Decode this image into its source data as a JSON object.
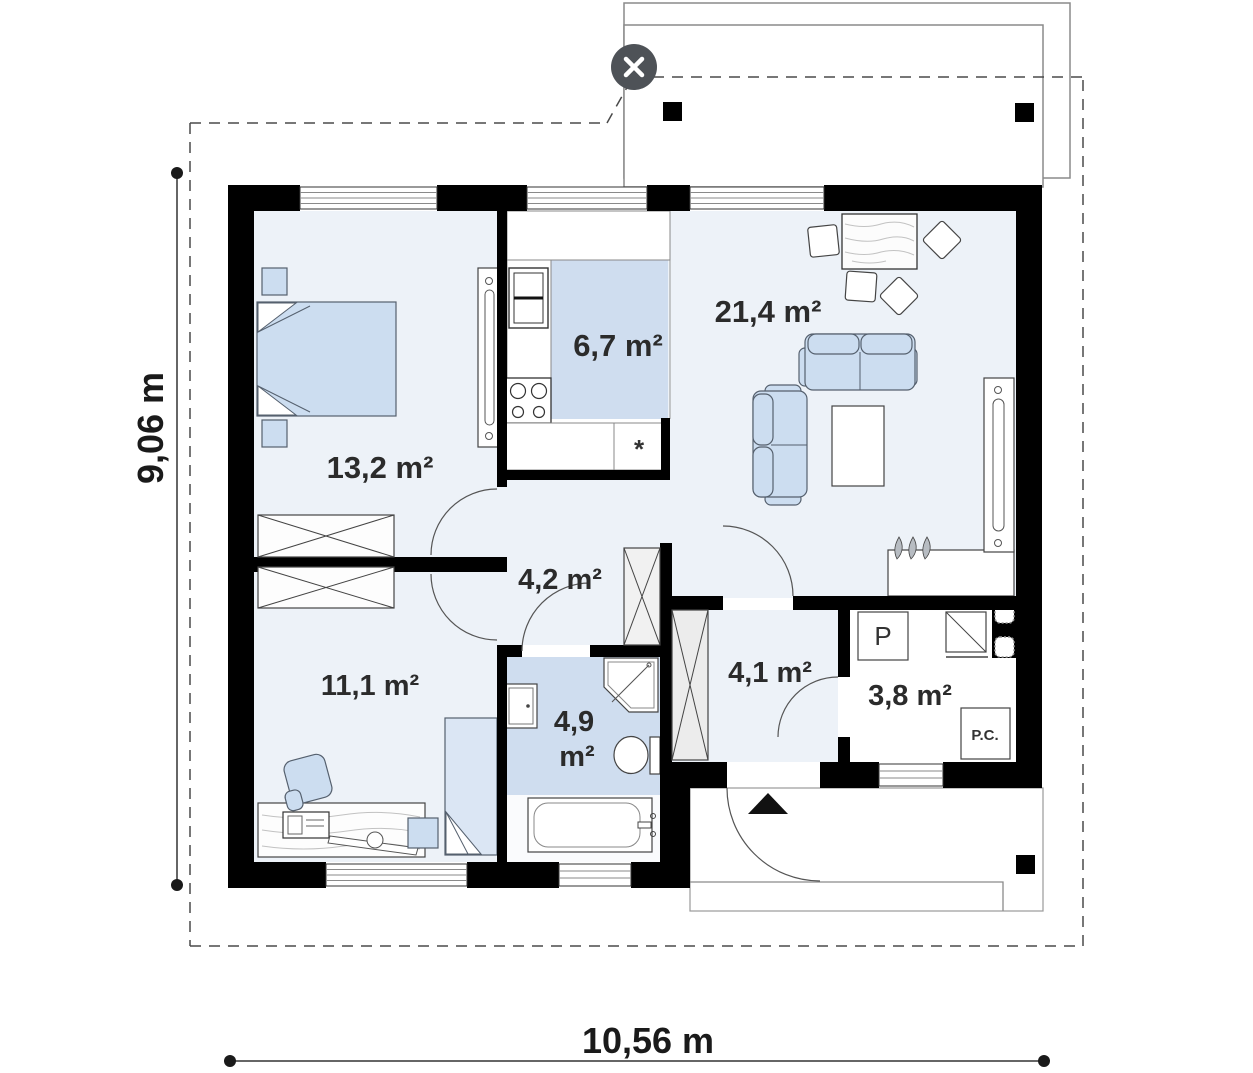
{
  "viewer": {
    "close_label": "×"
  },
  "plan": {
    "dimensions": {
      "height": "9,06 m",
      "width": "10,56 m"
    },
    "rooms": [
      {
        "name": "bedroom",
        "area": "13,2 m²"
      },
      {
        "name": "kitchen",
        "area": "6,7 m²"
      },
      {
        "name": "living-room",
        "area": "21,4 m²"
      },
      {
        "name": "hall",
        "area": "4,2 m²"
      },
      {
        "name": "room",
        "area": "11,1 m²"
      },
      {
        "name": "bathroom",
        "area_value": "4,9",
        "area_unit": "m²"
      },
      {
        "name": "entrance-hall",
        "area": "4,1 m²"
      },
      {
        "name": "utility-room",
        "area": "3,8 m²"
      }
    ],
    "markers": {
      "washing_machine": "P",
      "heating_unit": "P.C.",
      "sink": "*"
    }
  },
  "colors": {
    "wall": "#000000",
    "floor": "#edf2f8",
    "wet_floor": "#cfddef",
    "furniture": "#ccddf0",
    "close_button": "#4e5257"
  }
}
